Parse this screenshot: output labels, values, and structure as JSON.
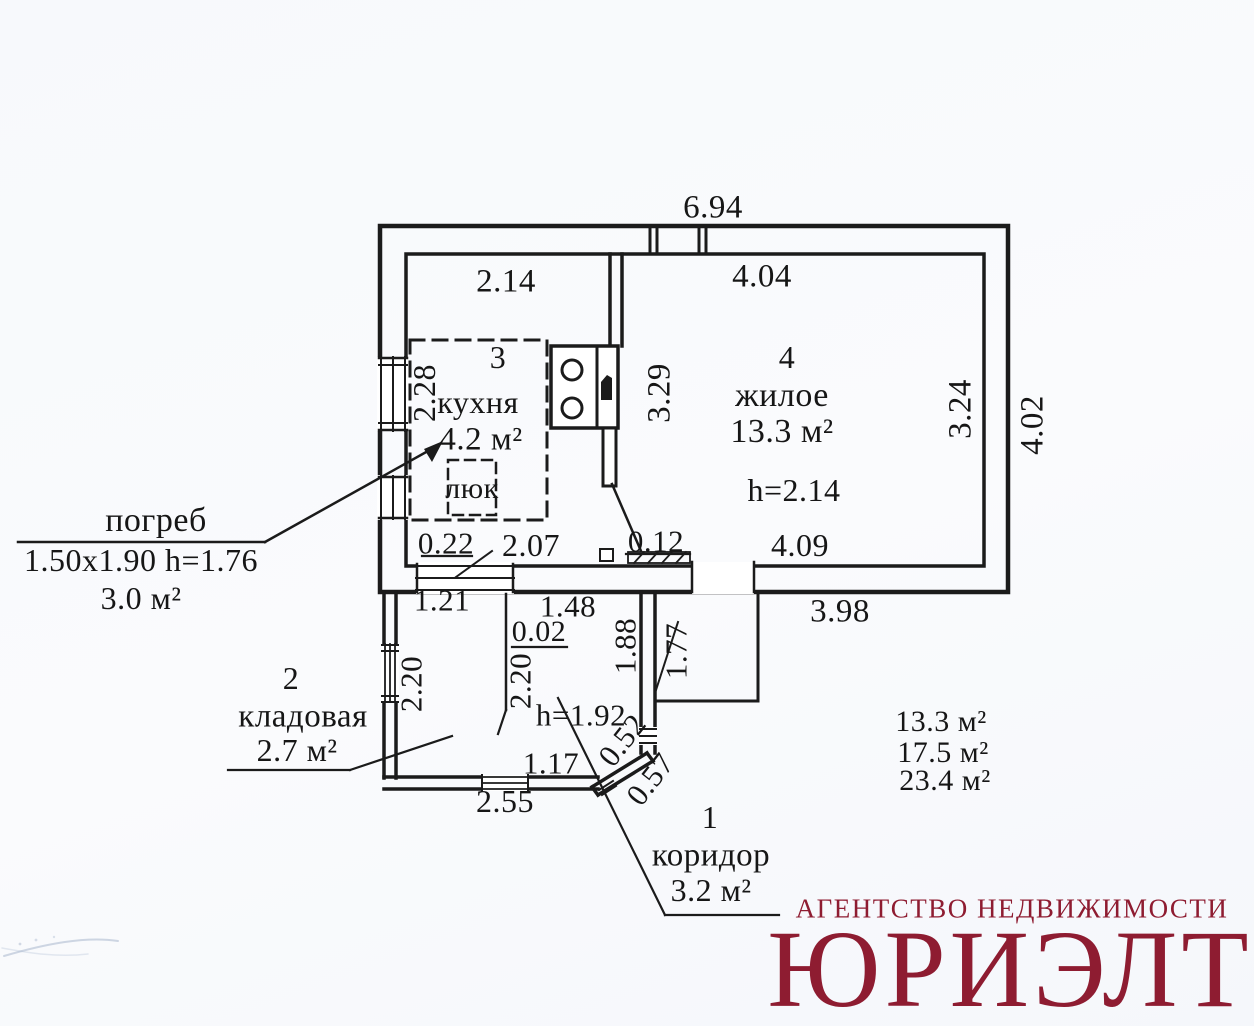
{
  "colors": {
    "ink": "#1b1b1b",
    "brand": "#8e1c31",
    "paper": "#f8f9fc"
  },
  "dims": {
    "total_width": "6.94",
    "kitchen_top": "2.14",
    "living_top": "4.04",
    "cellar_side": "2.28",
    "partition_height": "3.29",
    "living_right": "3.24",
    "outer_right": "4.02",
    "kitchen_window": "0.22",
    "kitchen_bottom": "2.07",
    "door_jamb": "0.12",
    "living_bottom": "4.09",
    "living_bottom_outer": "3.98",
    "storage_top": "1.21",
    "corridor_top": "1.48",
    "partition_gap": "0.02",
    "storage_left": "2.20",
    "storage_mid": "2.20",
    "corridor_left": "1.88",
    "corridor_right": "1.77",
    "corridor_ceiling": "h=1.92",
    "chamfer_upper": "0.52",
    "corridor_bottom": "1.17",
    "chamfer_lower": "0.57",
    "storage_bottom_outer": "2.55"
  },
  "rooms": {
    "corridor": {
      "num": "1",
      "name": "коридор",
      "area": "3.2 м²"
    },
    "storage": {
      "num": "2",
      "name": "кладовая",
      "area": "2.7 м²"
    },
    "kitchen": {
      "num": "3",
      "name": "кухня",
      "area": "4.2 м²",
      "hatch_label": "люк"
    },
    "living": {
      "num": "4",
      "name": "жилое",
      "area": "13.3 м²",
      "ceiling": "h=2.14"
    }
  },
  "cellar": {
    "name": "погреб",
    "size": "1.50x1.90 h=1.76",
    "area": "3.0 м²"
  },
  "summary": {
    "living": "13.3 м²",
    "auxiliary": "17.5 м²",
    "total": "23.4 м²"
  },
  "footer": {
    "agency": "АГЕНТСТВО НЕДВИЖИМОСТИ",
    "brand": "ЮРИЭЛТ"
  }
}
